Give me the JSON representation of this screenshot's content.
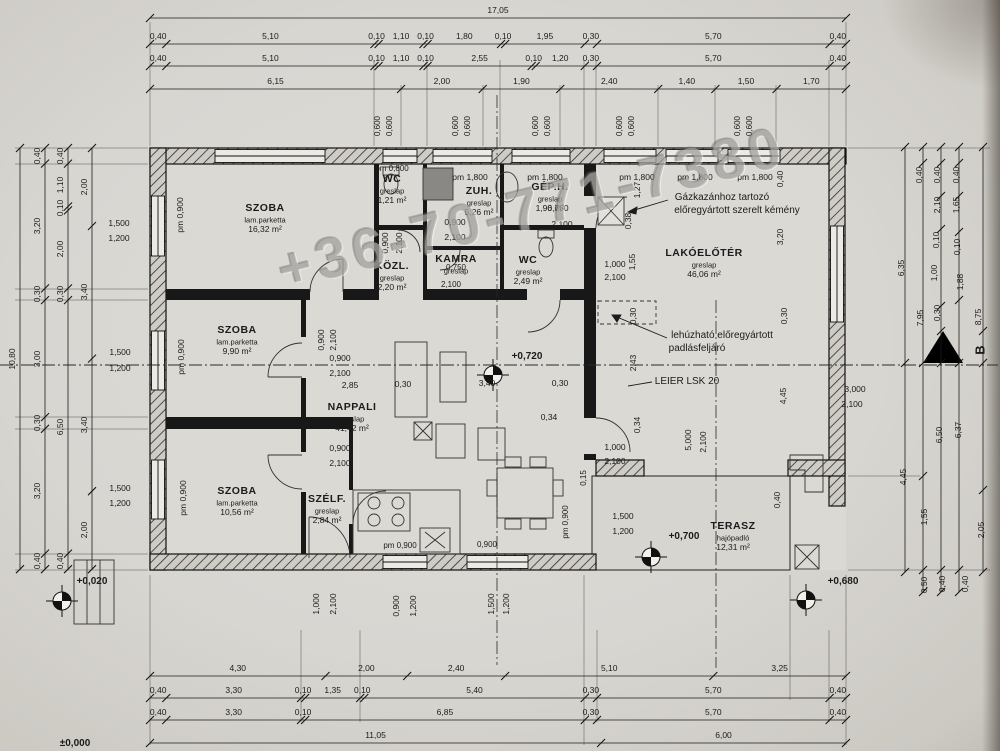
{
  "watermark": "+36-70-771-7380",
  "section_mark": "B",
  "rooms": [
    {
      "name": "SZOBA",
      "floor": "lam.parketta",
      "area": "16,32 m²",
      "x": 265,
      "y": 208
    },
    {
      "name": "SZOBA",
      "floor": "lam.parketta",
      "area": "9,90 m²",
      "x": 237,
      "y": 330
    },
    {
      "name": "SZOBA",
      "floor": "lam.parketta",
      "area": "10,56 m²",
      "x": 237,
      "y": 491
    },
    {
      "name": "NAPPALI",
      "floor": "greslap",
      "area": "41,42 m²",
      "x": 352,
      "y": 407
    },
    {
      "name": "KÖZL.",
      "floor": "greslap",
      "area": "2,20 m²",
      "x": 392,
      "y": 266
    },
    {
      "name": "WC",
      "floor": "greslap",
      "area": "1,21 m²",
      "x": 392,
      "y": 179
    },
    {
      "name": "ZUH.",
      "floor": "greslap",
      "area": "5,26 m²",
      "x": 479,
      "y": 191
    },
    {
      "name": "KAMRA",
      "floor": "greslap",
      "area": "",
      "x": 456,
      "y": 259
    },
    {
      "name": "GÉP.H.",
      "floor": "greslap",
      "area": "1,96 m²",
      "x": 550,
      "y": 187
    },
    {
      "name": "WC",
      "floor": "greslap",
      "area": "2,49 m²",
      "x": 528,
      "y": 260
    },
    {
      "name": "LAKÓELŐTÉR",
      "floor": "greslap",
      "area": "46,06 m²",
      "x": 704,
      "y": 253
    },
    {
      "name": "SZÉLF.",
      "floor": "greslap",
      "area": "2,84 m²",
      "x": 327,
      "y": 499
    },
    {
      "name": "TERASZ",
      "floor": "hajópadló",
      "area": "12,31 m²",
      "x": 733,
      "y": 526
    }
  ],
  "annotations": [
    {
      "t": "Gázkazánhoz tartozó",
      "x": 722,
      "y": 198
    },
    {
      "t": "előregyártott szerelt kémény",
      "x": 737,
      "y": 211
    },
    {
      "t": "lehúzható előregyártott",
      "x": 722,
      "y": 336
    },
    {
      "t": "padlásfeljáró",
      "x": 697,
      "y": 349
    },
    {
      "t": "LEIER LSK 20",
      "x": 687,
      "y": 382
    }
  ],
  "levels": [
    {
      "t": "+0,720",
      "x": 527,
      "y": 357
    },
    {
      "t": "+0,700",
      "x": 684,
      "y": 537
    },
    {
      "t": "+0,680",
      "x": 843,
      "y": 582
    },
    {
      "t": "+0,020",
      "x": 92,
      "y": 582
    },
    {
      "t": "±0,000",
      "x": 75,
      "y": 744
    }
  ],
  "labels": [
    {
      "t": "0,600",
      "x": 378,
      "y": 126,
      "r": 1,
      "s": 8
    },
    {
      "t": "0,600",
      "x": 390,
      "y": 126,
      "r": 1,
      "s": 8
    },
    {
      "t": "0,600",
      "x": 456,
      "y": 126,
      "r": 1,
      "s": 8
    },
    {
      "t": "0,600",
      "x": 468,
      "y": 126,
      "r": 1,
      "s": 8
    },
    {
      "t": "0,600",
      "x": 536,
      "y": 126,
      "r": 1,
      "s": 8
    },
    {
      "t": "0,600",
      "x": 548,
      "y": 126,
      "r": 1,
      "s": 8
    },
    {
      "t": "0,600",
      "x": 620,
      "y": 126,
      "r": 1,
      "s": 8
    },
    {
      "t": "0,600",
      "x": 632,
      "y": 126,
      "r": 1,
      "s": 8
    },
    {
      "t": "0,600",
      "x": 738,
      "y": 126,
      "r": 1,
      "s": 8
    },
    {
      "t": "0,600",
      "x": 750,
      "y": 126,
      "r": 1,
      "s": 8
    },
    {
      "t": "pm 1,800",
      "x": 470,
      "y": 177
    },
    {
      "t": "pm 1,800",
      "x": 545,
      "y": 177
    },
    {
      "t": "pm 1,800",
      "x": 637,
      "y": 177
    },
    {
      "t": "pm 1,800",
      "x": 695,
      "y": 177
    },
    {
      "t": "pm 1,800",
      "x": 755,
      "y": 177
    },
    {
      "t": "pm 0,800",
      "x": 392,
      "y": 169,
      "s": 8
    },
    {
      "t": "pm 0,900",
      "x": 180,
      "y": 215,
      "r": 1
    },
    {
      "t": "pm 0,900",
      "x": 181,
      "y": 357,
      "r": 1
    },
    {
      "t": "pm 0,900",
      "x": 183,
      "y": 498,
      "r": 1
    },
    {
      "t": "pm 0,900",
      "x": 566,
      "y": 522,
      "r": 1,
      "s": 8
    },
    {
      "t": "pm 0,900",
      "x": 400,
      "y": 546,
      "s": 8
    },
    {
      "t": "0,900",
      "x": 487,
      "y": 545,
      "s": 8
    },
    {
      "t": "1,500",
      "x": 119,
      "y": 223
    },
    {
      "t": "1,200",
      "x": 119,
      "y": 238
    },
    {
      "t": "1,500",
      "x": 120,
      "y": 352
    },
    {
      "t": "1,200",
      "x": 120,
      "y": 368
    },
    {
      "t": "1,500",
      "x": 120,
      "y": 488
    },
    {
      "t": "1,200",
      "x": 120,
      "y": 503
    },
    {
      "t": "1,500",
      "x": 623,
      "y": 516
    },
    {
      "t": "1,200",
      "x": 623,
      "y": 531
    },
    {
      "t": "1,000",
      "x": 316,
      "y": 604,
      "r": 1
    },
    {
      "t": "2,100",
      "x": 333,
      "y": 604,
      "r": 1
    },
    {
      "t": "0,900",
      "x": 396,
      "y": 606,
      "r": 1
    },
    {
      "t": "1,200",
      "x": 413,
      "y": 606,
      "r": 1
    },
    {
      "t": "1,500",
      "x": 491,
      "y": 604,
      "r": 1
    },
    {
      "t": "1,200",
      "x": 506,
      "y": 604,
      "r": 1
    },
    {
      "t": "0,900",
      "x": 455,
      "y": 222
    },
    {
      "t": "2,100",
      "x": 455,
      "y": 237
    },
    {
      "t": "0,900",
      "x": 340,
      "y": 358
    },
    {
      "t": "2,100",
      "x": 340,
      "y": 373
    },
    {
      "t": "0,900",
      "x": 340,
      "y": 448
    },
    {
      "t": "2,100",
      "x": 340,
      "y": 463
    },
    {
      "t": "0,900",
      "x": 385,
      "y": 243,
      "r": 1
    },
    {
      "t": "2,100",
      "x": 399,
      "y": 243,
      "r": 1
    },
    {
      "t": "0,900",
      "x": 321,
      "y": 340,
      "r": 1
    },
    {
      "t": "2,100",
      "x": 333,
      "y": 340,
      "r": 1
    },
    {
      "t": "1,000",
      "x": 615,
      "y": 264
    },
    {
      "t": "2,100",
      "x": 615,
      "y": 277
    },
    {
      "t": "1,000",
      "x": 615,
      "y": 447
    },
    {
      "t": "2,100",
      "x": 615,
      "y": 461
    },
    {
      "t": "5,000",
      "x": 688,
      "y": 440,
      "r": 1
    },
    {
      "t": "2,100",
      "x": 703,
      "y": 442,
      "r": 1
    },
    {
      "t": "3,000",
      "x": 855,
      "y": 389
    },
    {
      "t": "2,100",
      "x": 852,
      "y": 404
    },
    {
      "t": "2,85",
      "x": 350,
      "y": 385
    },
    {
      "t": "0,30",
      "x": 403,
      "y": 384
    },
    {
      "t": "3,40",
      "x": 487,
      "y": 383
    },
    {
      "t": "0,30",
      "x": 560,
      "y": 383
    },
    {
      "t": "0,34",
      "x": 549,
      "y": 417
    },
    {
      "t": "0,34",
      "x": 637,
      "y": 425,
      "r": 1
    },
    {
      "t": "2,43",
      "x": 633,
      "y": 363,
      "r": 1
    },
    {
      "t": "0,30",
      "x": 633,
      "y": 316,
      "r": 1
    },
    {
      "t": "0,30",
      "x": 784,
      "y": 316,
      "r": 1
    },
    {
      "t": "4,45",
      "x": 783,
      "y": 396,
      "r": 1
    },
    {
      "t": "0,40",
      "x": 777,
      "y": 500,
      "r": 1
    },
    {
      "t": "0,40",
      "x": 780,
      "y": 179,
      "r": 1
    },
    {
      "t": "3,20",
      "x": 780,
      "y": 237,
      "r": 1
    },
    {
      "t": "1,27",
      "x": 637,
      "y": 190,
      "r": 1
    },
    {
      "t": "0,38",
      "x": 628,
      "y": 221,
      "r": 1
    },
    {
      "t": "1,55",
      "x": 632,
      "y": 262,
      "r": 1
    },
    {
      "t": "0,15",
      "x": 584,
      "y": 478,
      "r": 1,
      "s": 8
    },
    {
      "t": "0,750",
      "x": 456,
      "y": 268,
      "s": 8
    },
    {
      "t": "2,100",
      "x": 451,
      "y": 285,
      "s": 8
    },
    {
      "t": "0,750",
      "x": 558,
      "y": 208
    },
    {
      "t": "2,100",
      "x": 562,
      "y": 224
    }
  ],
  "chains": {
    "ppm_x": 40.82,
    "ppm_y": 39.0,
    "x0": 150,
    "y0": 148,
    "top": [
      {
        "ly": 10,
        "line": 18,
        "segs": [
          "17,05"
        ]
      },
      {
        "ly": 36,
        "line": 44,
        "segs": [
          "0,40",
          "5,10",
          "0,10",
          "1,10",
          "0,10",
          "1,80",
          "0,10",
          "1,95",
          "0,30",
          "5,70",
          "0,40"
        ]
      },
      {
        "ly": 58,
        "line": 66,
        "segs": [
          "0,40",
          "5,10",
          "0,10",
          "1,10",
          "0,10",
          "2,55",
          "0,10",
          "1,20",
          "0,30",
          "5,70",
          "0,40"
        ]
      },
      {
        "ly": 81,
        "line": 89,
        "segs": [
          "6,15",
          "2,00",
          "1,90",
          "2,40",
          "1,40",
          "1,50",
          "1,70"
        ]
      }
    ],
    "bottom": [
      {
        "ly": 668,
        "line": 676,
        "segs": [
          "4,30",
          "2,00",
          "2,40",
          "5,10",
          "3,25"
        ]
      },
      {
        "ly": 690,
        "line": 698,
        "segs": [
          "0,40",
          "3,30",
          "0,10",
          "1,35",
          "0,10",
          "5,40",
          "0,30",
          "5,70",
          "0,40"
        ]
      },
      {
        "ly": 712,
        "line": 720,
        "segs": [
          "0,40",
          "3,30",
          "0,10",
          "6,85",
          "0,30",
          "5,70",
          "0,40"
        ]
      },
      {
        "ly": 735,
        "line": 743,
        "segs": [
          "11,05",
          "6,00"
        ]
      }
    ],
    "left": [
      {
        "lx": 12,
        "line": 20,
        "segs": [
          "10,80"
        ]
      },
      {
        "lx": 37,
        "line": 45,
        "segs": [
          "0,40",
          "3,20",
          "0,30",
          "3,00",
          "0,30",
          "3,20",
          "0,40"
        ]
      },
      {
        "lx": 60,
        "line": 68,
        "segs": [
          "0,40",
          "1,10",
          "0,10",
          "2,00",
          "0,30",
          "6,50",
          "0,40"
        ]
      },
      {
        "lx": 84,
        "line": 92,
        "segs": [
          "2,00",
          "3,40",
          "3,40",
          "2,00"
        ]
      }
    ]
  },
  "right_margin": {
    "lines": [
      {
        "x": 905,
        "y1": 147,
        "y2": 572,
        "ticks": [
          147,
          363,
          572
        ]
      },
      {
        "x": 923,
        "y1": 147,
        "y2": 592,
        "ticks": [
          147,
          163,
          363,
          476,
          570,
          592
        ]
      },
      {
        "x": 941,
        "y1": 147,
        "y2": 592,
        "ticks": [
          147,
          163,
          196,
          229,
          306,
          331,
          363,
          570,
          592
        ]
      },
      {
        "x": 959,
        "y1": 147,
        "y2": 592,
        "ticks": [
          147,
          163,
          196,
          232,
          300,
          363,
          570,
          592
        ]
      },
      {
        "x": 983,
        "y1": 147,
        "y2": 572,
        "ticks": [
          147,
          331,
          363,
          490,
          572
        ]
      }
    ],
    "labels": [
      {
        "t": "6,35",
        "x": 901,
        "y": 268,
        "r": 1
      },
      {
        "t": "7,95",
        "x": 920,
        "y": 318,
        "r": 1
      },
      {
        "t": "0,40",
        "x": 919,
        "y": 175,
        "r": 1
      },
      {
        "t": "0,40",
        "x": 937,
        "y": 175,
        "r": 1
      },
      {
        "t": "2,10",
        "x": 937,
        "y": 205,
        "r": 1
      },
      {
        "t": "0,10",
        "x": 936,
        "y": 240,
        "r": 1
      },
      {
        "t": "1,00",
        "x": 934,
        "y": 273,
        "r": 1
      },
      {
        "t": "0,30",
        "x": 937,
        "y": 313,
        "r": 1
      },
      {
        "t": "0,40",
        "x": 956,
        "y": 175,
        "r": 1
      },
      {
        "t": "1,65",
        "x": 956,
        "y": 205,
        "r": 1
      },
      {
        "t": "0,10",
        "x": 957,
        "y": 247,
        "r": 1
      },
      {
        "t": "1,88",
        "x": 960,
        "y": 282,
        "r": 1
      },
      {
        "t": "8,75",
        "x": 978,
        "y": 317,
        "r": 1
      },
      {
        "t": "B",
        "x": 980,
        "y": 350,
        "r": 1,
        "s": 13,
        "b": 1
      },
      {
        "t": "4,45",
        "x": 903,
        "y": 477,
        "r": 1
      },
      {
        "t": "1,55",
        "x": 924,
        "y": 517,
        "r": 1
      },
      {
        "t": "0,50",
        "x": 924,
        "y": 585,
        "r": 1
      },
      {
        "t": "6,50",
        "x": 939,
        "y": 435,
        "r": 1
      },
      {
        "t": "0,40",
        "x": 942,
        "y": 584,
        "r": 1
      },
      {
        "t": "6,37",
        "x": 958,
        "y": 430,
        "r": 1
      },
      {
        "t": "0,40",
        "x": 965,
        "y": 584,
        "r": 1
      },
      {
        "t": "2,05",
        "x": 981,
        "y": 530,
        "r": 1
      }
    ]
  }
}
